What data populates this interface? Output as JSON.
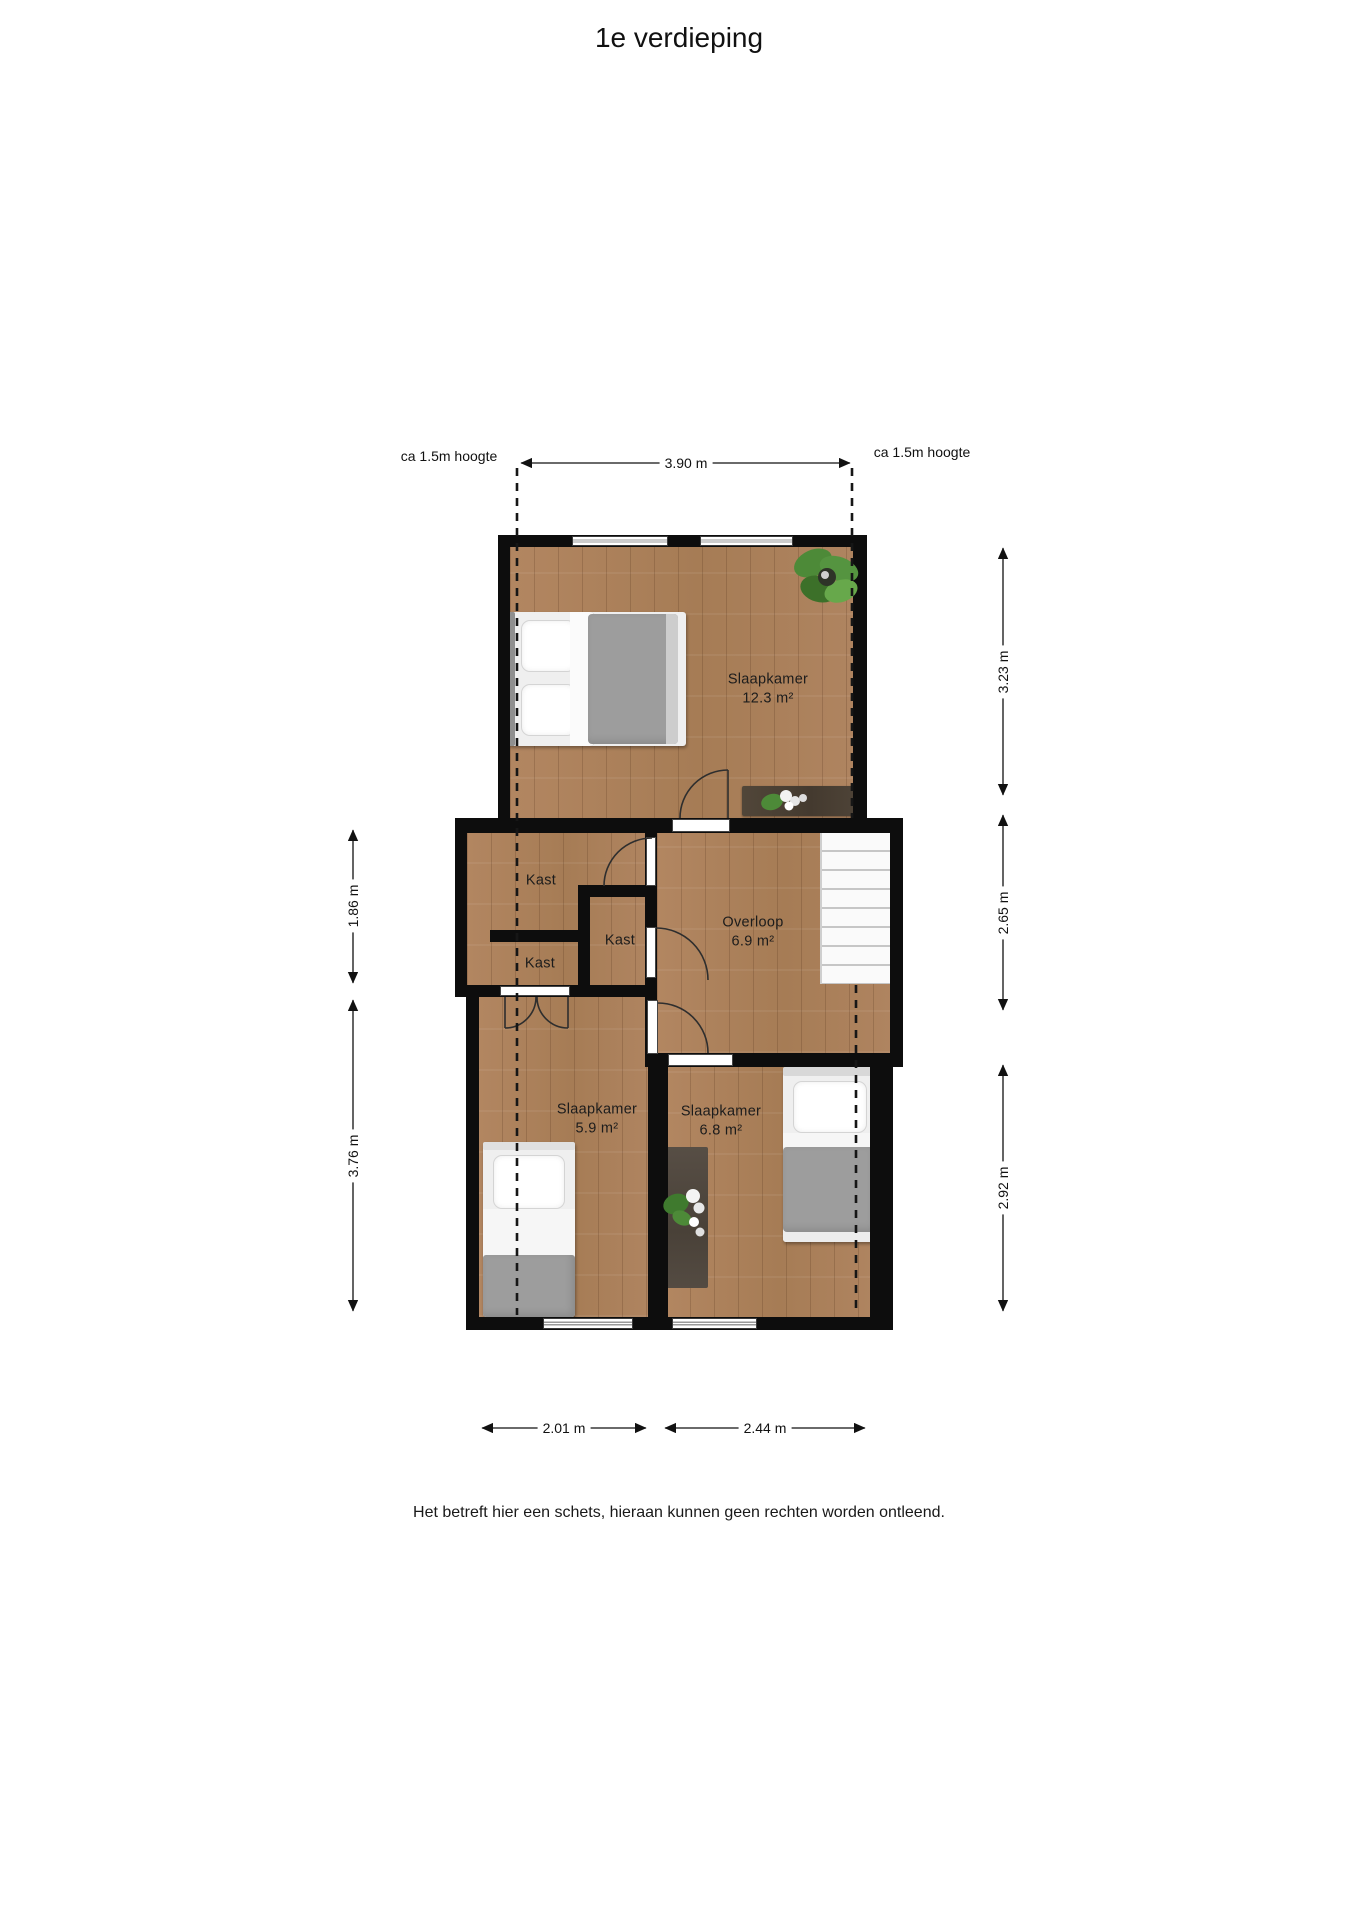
{
  "title": "1e verdieping",
  "plan": {
    "rooms": {
      "master": {
        "label": "Slaapkamer",
        "area": "12.3 m²"
      },
      "kast_top": {
        "label": "Kast"
      },
      "kast_mid": {
        "label": "Kast"
      },
      "kast_lower": {
        "label": "Kast"
      },
      "overloop": {
        "label": "Overloop",
        "area": "6.9 m²"
      },
      "bedroom_left": {
        "label": "Slaapkamer",
        "area": "5.9 m²"
      },
      "bedroom_right": {
        "label": "Slaapkamer",
        "area": "6.8 m²"
      }
    },
    "annotations": {
      "height_left": "ca 1.5m hoogte",
      "height_right": "ca 1.5m hoogte"
    },
    "dimensions": {
      "top": "3.90 m",
      "left_upper": "1.86 m",
      "left_lower": "3.76 m",
      "right_upper": "3.23 m",
      "right_middle": "2.65 m",
      "right_lower": "2.92 m",
      "bottom_left": "2.01 m",
      "bottom_right": "2.44 m"
    },
    "colors": {
      "floor_wood": "#ab8059",
      "wall": "#0d0d0d",
      "plant_green": "#4d8a38",
      "rug_dark": "#4e463e",
      "bed_duvet": "#9d9d9d"
    }
  },
  "footer": {
    "disclaimer": "Het betreft hier een schets, hieraan kunnen geen rechten worden ontleend."
  }
}
